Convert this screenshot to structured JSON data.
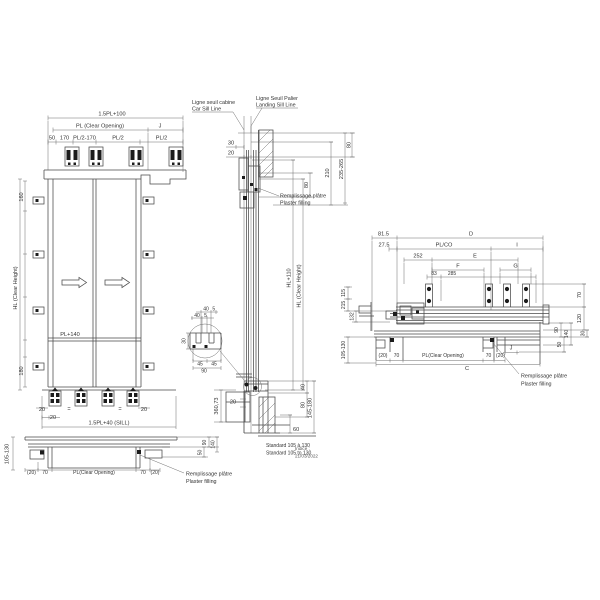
{
  "left_view": {
    "top_dims": {
      "overall": "1.5PL+100",
      "clear_opening": "PL (Clear Opening)",
      "j": "J",
      "d50": "50",
      "d170": "170",
      "pl2_170": "PL/2-170",
      "pl2_a": "PL/2",
      "pl2_b": "PL/2"
    },
    "side_dims": {
      "hl": "HL (Clear Height)",
      "d160": "160",
      "d180": "180"
    },
    "panel_dims": {
      "pl140": "PL+140"
    },
    "bottom_dims": {
      "d20_left": "20",
      "d20_right": "20",
      "d20_sill": "20",
      "eq1": "=",
      "eq2": "=",
      "sill": "1.5PL+40 (SILL)"
    }
  },
  "left_plan": {
    "depth": "105-130",
    "p20l": "(20)",
    "d70l": "70",
    "clear_opening": "PL(Clear Opening)",
    "d70r": "70",
    "p20r": "(20)",
    "d90": "90",
    "d140": "140",
    "d50": "50",
    "note_fr": "Remplissage plâtre",
    "note_en": "Plaster filling"
  },
  "section": {
    "car_sill_fr": "Ligne seuil cabine",
    "car_sill_en": "Car Sill Line",
    "landing_sill_fr": "Ligne Seuil Palier",
    "landing_sill_en": "Landing Sill Line",
    "d30": "30",
    "d20": "20",
    "d80_inner": "80",
    "d210": "210",
    "d235_265": "235-265",
    "d80_top": "80",
    "note_fr": "Remplissage plâtre",
    "note_en": "Plaster filling",
    "hl110": "HL+110",
    "hl": "HL (Clear Height)",
    "detail": {
      "d40a": "40",
      "d5a": "5",
      "d40b": "40",
      "d5b": "5",
      "d30": "30",
      "d45a": "45",
      "d45b": "45",
      "d90": "90"
    },
    "d360": "360,73",
    "d20b": "20",
    "d40": "40",
    "d80b": "80",
    "d145_180": "145-180",
    "d60": "60",
    "standard_fr": "Standard 105 à 130",
    "standard_en": "Standard 105 to 130"
  },
  "plan_view": {
    "d815": "81.5",
    "d275": "27.5",
    "D": "D",
    "plco": "PL/CO",
    "I": "I",
    "d252": "252",
    "E": "E",
    "F": "F",
    "G": "G",
    "d83": "83",
    "d285": "285",
    "d115": "115",
    "d215": "215",
    "d132": "132",
    "d105_130": "105-130",
    "d70r": "70",
    "d120": "120",
    "d90": "90",
    "d140": "140",
    "d30": "30",
    "d50": "50",
    "p20l": "(20)",
    "d70bl": "70",
    "clear_opening": "PL(Clear Opening)",
    "d70br": "70",
    "p20r": "(20)",
    "C": "C",
    "J": "J",
    "note_fr": "Remplissage plâtre",
    "note_en": "Plaster filling"
  },
  "revision": {
    "label": "Indice :",
    "date": "21/03/2022"
  }
}
